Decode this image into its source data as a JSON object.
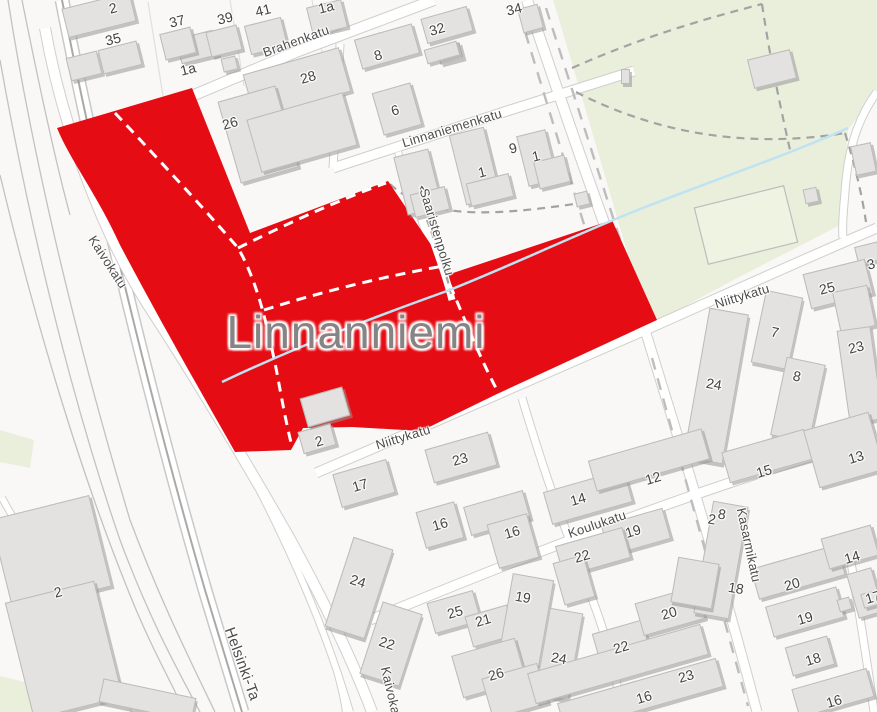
{
  "map": {
    "place_label": "Linnanniemi",
    "colors": {
      "highlight_red": "#e60c13",
      "park_green": "#e9efdb",
      "field_green": "#eef3e2",
      "building_gray": "#e3e2e0",
      "stream_blue": "#bfe3f2",
      "road_white": "#ffffff",
      "road_casing": "#cfcfcd",
      "label_gray": "#4c4c4c"
    },
    "place_label_pos": {
      "x": 356,
      "y": 332
    },
    "street_labels": [
      {
        "text": "Brahenkatu",
        "x": 296,
        "y": 41,
        "rot": -20,
        "size": 13
      },
      {
        "text": "Linnaniemenkatu",
        "x": 452,
        "y": 128,
        "rot": -17,
        "size": 13
      },
      {
        "text": "Saaristenpolku",
        "x": 437,
        "y": 232,
        "rot": 73,
        "size": 13
      },
      {
        "text": "Kaivokatu",
        "x": 108,
        "y": 262,
        "rot": 57,
        "size": 13
      },
      {
        "text": "Kaivokatu",
        "x": 392,
        "y": 696,
        "rot": 77,
        "size": 13
      },
      {
        "text": "Niittykatu",
        "x": 403,
        "y": 437,
        "rot": -17,
        "size": 13
      },
      {
        "text": "Niittykatu",
        "x": 742,
        "y": 296,
        "rot": -17,
        "size": 13
      },
      {
        "text": "Koulukatu",
        "x": 597,
        "y": 524,
        "rot": -19,
        "size": 13
      },
      {
        "text": "Kasarmikatu",
        "x": 749,
        "y": 545,
        "rot": 78,
        "size": 13
      },
      {
        "text": "Helsinki-Ta",
        "x": 242,
        "y": 664,
        "rot": 70,
        "size": 15
      }
    ],
    "house_numbers": [
      {
        "text": "2",
        "x": 113,
        "y": 8,
        "rot": -14
      },
      {
        "text": "1a",
        "x": 188,
        "y": 69,
        "rot": -14
      },
      {
        "text": "37",
        "x": 177,
        "y": 21,
        "rot": -14
      },
      {
        "text": "39",
        "x": 225,
        "y": 18,
        "rot": -14
      },
      {
        "text": "41",
        "x": 263,
        "y": 10,
        "rot": -14
      },
      {
        "text": "35",
        "x": 113,
        "y": 39,
        "rot": -14
      },
      {
        "text": "1a",
        "x": 326,
        "y": 7,
        "rot": -14
      },
      {
        "text": "34",
        "x": 514,
        "y": 9,
        "rot": -14
      },
      {
        "text": "32",
        "x": 437,
        "y": 29,
        "rot": -16
      },
      {
        "text": "8",
        "x": 378,
        "y": 55,
        "rot": -16
      },
      {
        "text": "28",
        "x": 308,
        "y": 77,
        "rot": -16
      },
      {
        "text": "26",
        "x": 230,
        "y": 123,
        "rot": -16
      },
      {
        "text": "6",
        "x": 395,
        "y": 110,
        "rot": -16
      },
      {
        "text": "9",
        "x": 513,
        "y": 148,
        "rot": -14
      },
      {
        "text": "1",
        "x": 482,
        "y": 172,
        "rot": -14
      },
      {
        "text": "1",
        "x": 536,
        "y": 156,
        "rot": -14
      },
      {
        "text": "1",
        "x": 424,
        "y": 190,
        "rot": -35
      },
      {
        "text": "3",
        "x": 871,
        "y": 264,
        "rot": -14
      },
      {
        "text": "25",
        "x": 827,
        "y": 288,
        "rot": -14
      },
      {
        "text": "23",
        "x": 856,
        "y": 347,
        "rot": -14
      },
      {
        "text": "7",
        "x": 775,
        "y": 332,
        "rot": 12
      },
      {
        "text": "8",
        "x": 797,
        "y": 376,
        "rot": 12
      },
      {
        "text": "24",
        "x": 714,
        "y": 384,
        "rot": 10
      },
      {
        "text": "2",
        "x": 319,
        "y": 441,
        "rot": -16
      },
      {
        "text": "17",
        "x": 360,
        "y": 485,
        "rot": -16
      },
      {
        "text": "23",
        "x": 460,
        "y": 459,
        "rot": -16
      },
      {
        "text": "16",
        "x": 440,
        "y": 524,
        "rot": -16
      },
      {
        "text": "16",
        "x": 512,
        "y": 532,
        "rot": -16
      },
      {
        "text": "14",
        "x": 578,
        "y": 499,
        "rot": -16
      },
      {
        "text": "12",
        "x": 653,
        "y": 478,
        "rot": -16
      },
      {
        "text": "15",
        "x": 764,
        "y": 471,
        "rot": -16
      },
      {
        "text": "13",
        "x": 856,
        "y": 457,
        "rot": -16
      },
      {
        "text": "22",
        "x": 582,
        "y": 556,
        "rot": -16
      },
      {
        "text": "19",
        "x": 633,
        "y": 531,
        "rot": -16
      },
      {
        "text": "24",
        "x": 358,
        "y": 581,
        "rot": 18
      },
      {
        "text": "22",
        "x": 387,
        "y": 643,
        "rot": 18
      },
      {
        "text": "25",
        "x": 455,
        "y": 612,
        "rot": -16
      },
      {
        "text": "21",
        "x": 483,
        "y": 620,
        "rot": -16
      },
      {
        "text": "19",
        "x": 523,
        "y": 597,
        "rot": 10
      },
      {
        "text": "26",
        "x": 496,
        "y": 674,
        "rot": -16
      },
      {
        "text": "24",
        "x": 559,
        "y": 658,
        "rot": 10
      },
      {
        "text": "22",
        "x": 621,
        "y": 647,
        "rot": -16
      },
      {
        "text": "20",
        "x": 669,
        "y": 613,
        "rot": -16
      },
      {
        "text": "23",
        "x": 686,
        "y": 676,
        "rot": -16
      },
      {
        "text": "16",
        "x": 644,
        "y": 697,
        "rot": -16
      },
      {
        "text": "2",
        "x": 712,
        "y": 519,
        "rot": 10
      },
      {
        "text": "8",
        "x": 722,
        "y": 514,
        "rot": 10
      },
      {
        "text": "18",
        "x": 736,
        "y": 588,
        "rot": 10
      },
      {
        "text": "20",
        "x": 792,
        "y": 584,
        "rot": -16
      },
      {
        "text": "19",
        "x": 805,
        "y": 618,
        "rot": -16
      },
      {
        "text": "18",
        "x": 813,
        "y": 659,
        "rot": -16
      },
      {
        "text": "16",
        "x": 834,
        "y": 701,
        "rot": -16
      },
      {
        "text": "14",
        "x": 852,
        "y": 557,
        "rot": -16
      },
      {
        "text": "17",
        "x": 873,
        "y": 597,
        "rot": -16
      },
      {
        "text": "2",
        "x": 58,
        "y": 592,
        "rot": -14
      }
    ],
    "buildings": [
      {
        "x": 64,
        "y": 0,
        "w": 70,
        "h": 30,
        "r": -14
      },
      {
        "x": 178,
        "y": 34,
        "w": 38,
        "h": 26,
        "r": -14
      },
      {
        "x": 68,
        "y": 54,
        "w": 32,
        "h": 24,
        "r": -14
      },
      {
        "x": 100,
        "y": 45,
        "w": 40,
        "h": 25,
        "r": -14
      },
      {
        "x": 222,
        "y": 57,
        "w": 15,
        "h": 14,
        "r": -14
      },
      {
        "x": 162,
        "y": 30,
        "w": 32,
        "h": 27,
        "r": -14
      },
      {
        "x": 208,
        "y": 28,
        "w": 32,
        "h": 26,
        "r": -14
      },
      {
        "x": 247,
        "y": 21,
        "w": 38,
        "h": 30,
        "r": -14
      },
      {
        "x": 309,
        "y": 3,
        "w": 36,
        "h": 29,
        "r": -14
      },
      {
        "x": 438,
        "y": 45,
        "w": 24,
        "h": 17,
        "r": -15
      },
      {
        "x": 520,
        "y": 6,
        "w": 21,
        "h": 25,
        "r": -15
      },
      {
        "x": 423,
        "y": 12,
        "w": 48,
        "h": 26,
        "r": -16
      },
      {
        "x": 425,
        "y": 45,
        "w": 34,
        "h": 15,
        "r": -16
      },
      {
        "x": 357,
        "y": 31,
        "w": 60,
        "h": 31,
        "r": -16
      },
      {
        "x": 247,
        "y": 60,
        "w": 100,
        "h": 46,
        "r": -16
      },
      {
        "x": 228,
        "y": 92,
        "w": 60,
        "h": 85,
        "r": -16
      },
      {
        "x": 252,
        "y": 105,
        "w": 100,
        "h": 55,
        "r": -16
      },
      {
        "x": 377,
        "y": 87,
        "w": 40,
        "h": 44,
        "r": -16
      },
      {
        "x": 400,
        "y": 152,
        "w": 36,
        "h": 60,
        "r": -14
      },
      {
        "x": 412,
        "y": 190,
        "w": 36,
        "h": 24,
        "r": -14
      },
      {
        "x": 457,
        "y": 130,
        "w": 36,
        "h": 72,
        "r": -14
      },
      {
        "x": 468,
        "y": 178,
        "w": 44,
        "h": 24,
        "r": -14
      },
      {
        "x": 522,
        "y": 132,
        "w": 30,
        "h": 52,
        "r": -14
      },
      {
        "x": 536,
        "y": 158,
        "w": 32,
        "h": 28,
        "r": -14
      },
      {
        "x": 621,
        "y": 69,
        "w": 9,
        "h": 15,
        "r": 0
      },
      {
        "x": 575,
        "y": 192,
        "w": 14,
        "h": 14,
        "r": -14
      },
      {
        "x": 750,
        "y": 54,
        "w": 44,
        "h": 30,
        "r": -14
      },
      {
        "x": 853,
        "y": 144,
        "w": 21,
        "h": 30,
        "r": -12
      },
      {
        "x": 804,
        "y": 188,
        "w": 14,
        "h": 15,
        "r": -12
      },
      {
        "x": 856,
        "y": 244,
        "w": 24,
        "h": 19,
        "r": -14
      },
      {
        "x": 806,
        "y": 266,
        "w": 64,
        "h": 36,
        "r": -14
      },
      {
        "x": 836,
        "y": 288,
        "w": 36,
        "h": 42,
        "r": -12
      },
      {
        "x": 843,
        "y": 328,
        "w": 34,
        "h": 94,
        "r": -8
      },
      {
        "x": 758,
        "y": 293,
        "w": 38,
        "h": 74,
        "r": 12
      },
      {
        "x": 778,
        "y": 360,
        "w": 40,
        "h": 80,
        "r": 12
      },
      {
        "x": 696,
        "y": 310,
        "w": 40,
        "h": 152,
        "r": 10
      },
      {
        "x": 300,
        "y": 427,
        "w": 34,
        "h": 23,
        "r": -16
      },
      {
        "x": 303,
        "y": 392,
        "w": 44,
        "h": 30,
        "r": -16
      },
      {
        "x": 336,
        "y": 466,
        "w": 56,
        "h": 35,
        "r": -16
      },
      {
        "x": 428,
        "y": 440,
        "w": 66,
        "h": 35,
        "r": -16
      },
      {
        "x": 420,
        "y": 506,
        "w": 40,
        "h": 38,
        "r": -16
      },
      {
        "x": 466,
        "y": 498,
        "w": 62,
        "h": 30,
        "r": -16
      },
      {
        "x": 492,
        "y": 518,
        "w": 42,
        "h": 46,
        "r": -16
      },
      {
        "x": 338,
        "y": 541,
        "w": 42,
        "h": 94,
        "r": 18
      },
      {
        "x": 370,
        "y": 606,
        "w": 42,
        "h": 76,
        "r": 18
      },
      {
        "x": 430,
        "y": 596,
        "w": 48,
        "h": 32,
        "r": -16
      },
      {
        "x": 468,
        "y": 610,
        "w": 44,
        "h": 32,
        "r": -16
      },
      {
        "x": 504,
        "y": 576,
        "w": 42,
        "h": 98,
        "r": 10
      },
      {
        "x": 456,
        "y": 646,
        "w": 66,
        "h": 44,
        "r": -16
      },
      {
        "x": 486,
        "y": 670,
        "w": 58,
        "h": 42,
        "r": -16
      },
      {
        "x": 542,
        "y": 610,
        "w": 34,
        "h": 88,
        "r": 10
      },
      {
        "x": 596,
        "y": 626,
        "w": 52,
        "h": 38,
        "r": -16
      },
      {
        "x": 638,
        "y": 594,
        "w": 64,
        "h": 34,
        "r": -16
      },
      {
        "x": 528,
        "y": 648,
        "w": 180,
        "h": 32,
        "r": -16
      },
      {
        "x": 558,
        "y": 680,
        "w": 165,
        "h": 30,
        "r": -16
      },
      {
        "x": 546,
        "y": 480,
        "w": 84,
        "h": 34,
        "r": -16
      },
      {
        "x": 590,
        "y": 444,
        "w": 118,
        "h": 32,
        "r": -16
      },
      {
        "x": 724,
        "y": 440,
        "w": 86,
        "h": 32,
        "r": -16
      },
      {
        "x": 810,
        "y": 420,
        "w": 68,
        "h": 60,
        "r": -16
      },
      {
        "x": 604,
        "y": 516,
        "w": 64,
        "h": 32,
        "r": -16
      },
      {
        "x": 558,
        "y": 536,
        "w": 70,
        "h": 32,
        "r": -16
      },
      {
        "x": 558,
        "y": 558,
        "w": 32,
        "h": 44,
        "r": -16
      },
      {
        "x": 703,
        "y": 503,
        "w": 36,
        "h": 114,
        "r": 10
      },
      {
        "x": 674,
        "y": 560,
        "w": 42,
        "h": 46,
        "r": 10
      },
      {
        "x": 753,
        "y": 556,
        "w": 90,
        "h": 32,
        "r": -16
      },
      {
        "x": 768,
        "y": 596,
        "w": 74,
        "h": 32,
        "r": -16
      },
      {
        "x": 788,
        "y": 641,
        "w": 44,
        "h": 30,
        "r": -16
      },
      {
        "x": 794,
        "y": 678,
        "w": 78,
        "h": 30,
        "r": -16
      },
      {
        "x": 824,
        "y": 531,
        "w": 52,
        "h": 32,
        "r": -16
      },
      {
        "x": 852,
        "y": 570,
        "w": 26,
        "h": 46,
        "r": -16
      },
      {
        "x": 838,
        "y": 598,
        "w": 13,
        "h": 13,
        "r": -16
      },
      {
        "x": 862,
        "y": 592,
        "w": 15,
        "h": 15,
        "r": -16
      },
      {
        "x": 0,
        "y": 506,
        "w": 102,
        "h": 94,
        "r": -14
      },
      {
        "x": 18,
        "y": 590,
        "w": 92,
        "h": 120,
        "r": -14
      },
      {
        "x": 100,
        "y": 688,
        "w": 95,
        "h": 24,
        "r": 12
      }
    ]
  }
}
